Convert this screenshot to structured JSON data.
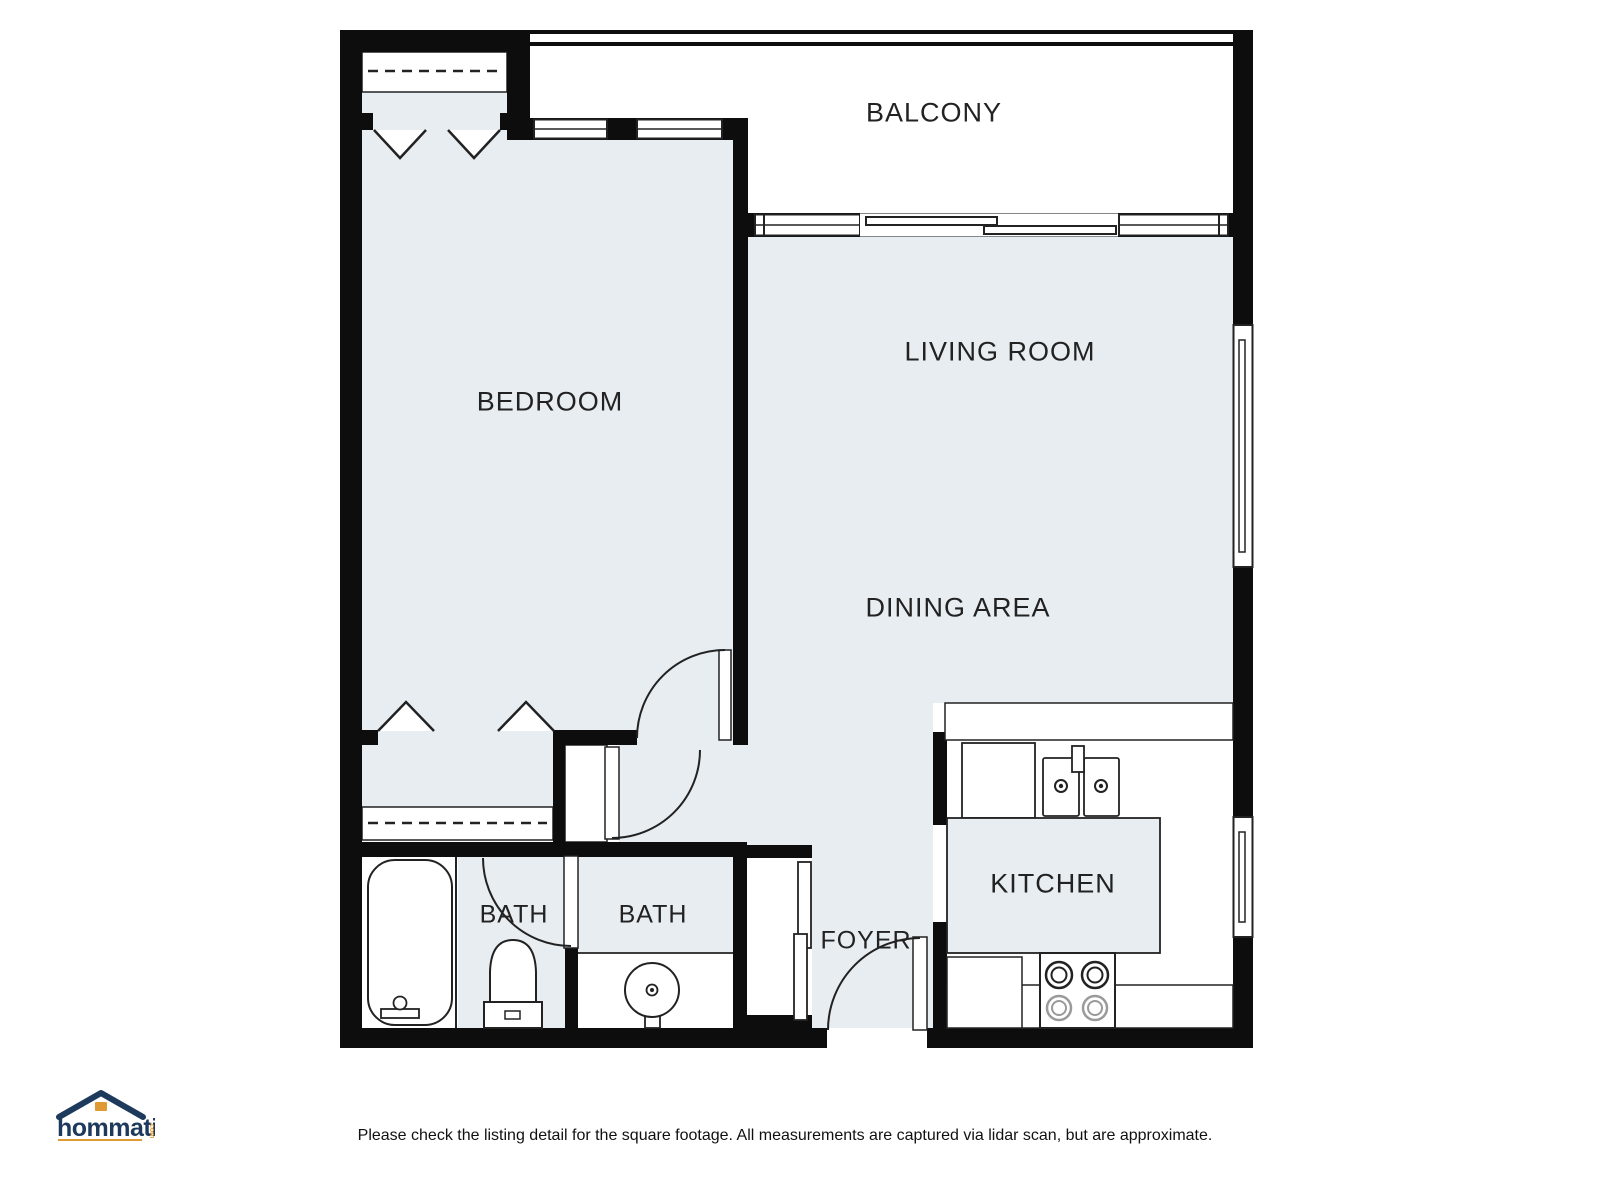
{
  "colors": {
    "floor": "#e8edf1",
    "wall": "#0d0d0d",
    "line": "#222222",
    "muted_line": "#9a9a9a",
    "label": "#222222",
    "logo_navy": "#1d3a5c",
    "logo_orange": "#e09a33"
  },
  "rooms": {
    "balcony": {
      "label": "BALCONY"
    },
    "bedroom": {
      "label": "BEDROOM"
    },
    "living_room": {
      "label": "LIVING ROOM"
    },
    "dining_area": {
      "label": "DINING AREA"
    },
    "kitchen": {
      "label": "KITCHEN"
    },
    "bath_1": {
      "label": "BATH"
    },
    "bath_2": {
      "label": "BATH"
    },
    "foyer": {
      "label": "FOYER"
    }
  },
  "fixtures": [
    "bathtub",
    "toilet",
    "pedestal-sink",
    "double-kitchen-sink",
    "stove",
    "refrigerator",
    "kitchen-island",
    "kitchen-counter",
    "closet-rod",
    "bifold-closet-doors",
    "sliding-glass-door",
    "sliding-closet-doors",
    "hinged-doors",
    "windows",
    "balcony-railing"
  ],
  "footer": {
    "disclaimer": "Please check the listing detail for the square footage. All measurements are captured via lidar scan, but are approximate."
  },
  "logo": {
    "text": "hommati",
    "suffix": ".com"
  }
}
